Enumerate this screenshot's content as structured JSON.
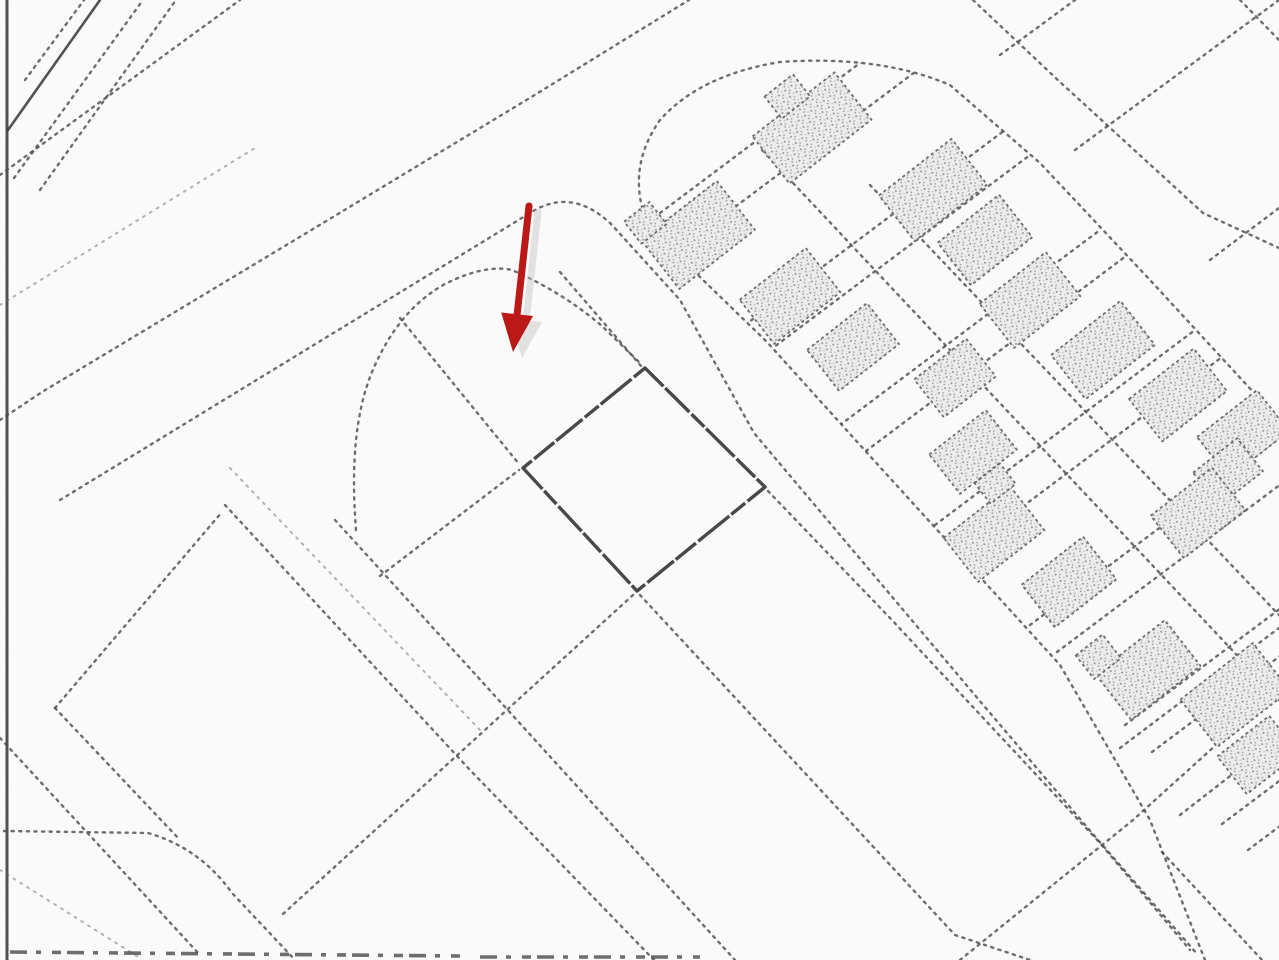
{
  "canvas": {
    "width": 1279,
    "height": 960
  },
  "colors": {
    "paper": "#ffffff",
    "ink": "#4e4e4e",
    "ink_dark": "#3a3a3a",
    "building_fill": "#ececec",
    "building_speckle": "#949494",
    "marker_red": "#bc1818",
    "marker_shadow": "#c4c4c4"
  },
  "marker": {
    "tail": [
      529,
      206
    ],
    "tip": [
      513,
      352
    ],
    "head_length": 38,
    "head_half_width": 16,
    "shaft_width": 7,
    "color": "#bc1818",
    "shadow_color": "#c4c4c4",
    "shadow_offset": [
      9,
      6
    ],
    "shadow_opacity": 0.45
  },
  "highlighted_parcel": {
    "points": "645,368 765,487 637,591 523,468"
  },
  "geometry": {
    "solid_lines": [
      {
        "d": "M7,0 L7,960",
        "w": 3
      },
      {
        "d": "M8,130 L100,0",
        "w": 2.6
      }
    ],
    "scan_marks": [
      {
        "d": "M10,952 L460,956"
      },
      {
        "d": "M480,957 L700,957"
      }
    ],
    "dotted": [
      {
        "d": "M25,80 L84,0"
      },
      {
        "d": "M14,178 L143,0"
      },
      {
        "d": "M40,190 L176,0"
      },
      {
        "d": "M0,175 L240,0"
      },
      {
        "d": "M0,305 L255,148",
        "c": "dot2"
      },
      {
        "d": "M0,420 L42,392 L333,217 L533,96 L689,0"
      },
      {
        "d": "M60,500 L530,213 Q572,186 612,225 L680,300 L754,433 L867,567 L979,700 L1092,833 L1198,955"
      },
      {
        "d": "M356,530 Q348,430 372,372 Q398,310 445,284 Q485,264 512,270 Q562,292 602,326 L641,364"
      },
      {
        "d": "M560,272 L641,366"
      },
      {
        "d": "M768,491 L890,618 L1000,736 L1100,843 L1190,950"
      },
      {
        "d": "M400,318 L519,464"
      },
      {
        "d": "M640,595 L955,935 L1030,960"
      },
      {
        "d": "M335,520 L735,960"
      },
      {
        "d": "M380,576 L519,470"
      },
      {
        "d": "M633,595 L283,914"
      },
      {
        "d": "M225,505 L470,770 L654,960"
      },
      {
        "d": "M230,468 L480,730",
        "c": "dot2"
      },
      {
        "d": "M55,708 L222,512"
      },
      {
        "d": "M55,708 L180,840"
      },
      {
        "d": "M0,738 L200,955"
      },
      {
        "d": "M4,831 L148,833 Q200,848 232,893 L295,960"
      },
      {
        "d": "M0,870 L140,958",
        "c": "dot2"
      },
      {
        "d": "M973,0 L1060,82 L1203,213 L1279,248"
      },
      {
        "d": "M1240,0 L1279,40"
      },
      {
        "d": "M1075,150 L1279,0"
      },
      {
        "d": "M1210,260 L1279,208"
      },
      {
        "d": "M1000,55 L1075,0"
      },
      {
        "d": "M960,960 L1133,820 L1279,688"
      },
      {
        "d": "M1162,852 L1262,960"
      },
      {
        "d": "M1120,748 L1279,628"
      },
      {
        "d": "M1180,815 L1279,738"
      }
    ],
    "band_outline": "M1205,960 L1150,820 L1060,665 L960,555 L860,445 L767,342 L703,280 L648,225 Q625,170 660,120 Q700,75 780,62 Q880,55 950,85 L1040,163 L1150,280 L1279,420",
    "band_clip": "M1205,960 L1150,820 L1060,665 L960,555 L860,445 L767,342 L703,280 L648,225 Q625,170 660,120 Q700,75 780,62 Q880,55 950,85 L1040,163 L1150,280 L1279,420 L1279,960 Z",
    "inner_lines": [
      {
        "d": "M762,150 L1279,700"
      },
      {
        "d": "M870,185 L1279,615"
      }
    ],
    "cross_streets": [
      {
        "d": "M648,222 L908,27"
      },
      {
        "d": "M675,252 L935,57"
      },
      {
        "d": "M745,325 L1005,130"
      },
      {
        "d": "M770,350 L1030,155"
      },
      {
        "d": "M840,425 L1100,230"
      },
      {
        "d": "M866,451 L1126,256"
      },
      {
        "d": "M935,525 L1195,330"
      },
      {
        "d": "M962,552 L1222,357"
      },
      {
        "d": "M1030,625 L1290,430"
      },
      {
        "d": "M1057,652 L1317,457"
      },
      {
        "d": "M1125,725 L1385,530"
      },
      {
        "d": "M1152,752 L1412,557"
      },
      {
        "d": "M1222,824 L1482,629"
      },
      {
        "d": "M1248,850 L1508,655"
      }
    ],
    "buildings": [
      {
        "cx": 812,
        "cy": 128,
        "w": 104,
        "h": 60,
        "rot": -38,
        "ext": [
          -18,
          -54,
          36,
          28
        ]
      },
      {
        "cx": 698,
        "cy": 235,
        "w": 96,
        "h": 62,
        "rot": -38,
        "ext": [
          -50,
          -56,
          32,
          28
        ]
      },
      {
        "cx": 790,
        "cy": 296,
        "w": 84,
        "h": 56,
        "rot": -38
      },
      {
        "cx": 853,
        "cy": 347,
        "w": 76,
        "h": 52,
        "rot": -38
      },
      {
        "cx": 933,
        "cy": 190,
        "w": 92,
        "h": 58,
        "rot": -38
      },
      {
        "cx": 985,
        "cy": 240,
        "w": 78,
        "h": 54,
        "rot": -38
      },
      {
        "cx": 1030,
        "cy": 300,
        "w": 84,
        "h": 56,
        "rot": -38
      },
      {
        "cx": 1103,
        "cy": 350,
        "w": 88,
        "h": 56,
        "rot": -38
      },
      {
        "cx": 1178,
        "cy": 395,
        "w": 82,
        "h": 54,
        "rot": -38
      },
      {
        "cx": 955,
        "cy": 378,
        "w": 66,
        "h": 48,
        "rot": -38
      },
      {
        "cx": 973,
        "cy": 452,
        "w": 72,
        "h": 50,
        "rot": -38
      },
      {
        "cx": 994,
        "cy": 534,
        "w": 84,
        "h": 56,
        "rot": -38,
        "ext": [
          16,
          -52,
          32,
          26
        ]
      },
      {
        "cx": 1069,
        "cy": 582,
        "w": 78,
        "h": 54,
        "rot": -38
      },
      {
        "cx": 1243,
        "cy": 434,
        "w": 76,
        "h": 52,
        "rot": -38
      },
      {
        "cx": 1228,
        "cy": 472,
        "w": 56,
        "h": 42,
        "rot": -38
      },
      {
        "cx": 1198,
        "cy": 513,
        "w": 78,
        "h": 54,
        "rot": -38
      },
      {
        "cx": 1148,
        "cy": 670,
        "w": 88,
        "h": 58,
        "rot": -38,
        "ext": [
          -48,
          -56,
          34,
          30
        ]
      },
      {
        "cx": 1235,
        "cy": 695,
        "w": 92,
        "h": 60,
        "rot": -38
      },
      {
        "cx": 1258,
        "cy": 755,
        "w": 66,
        "h": 48,
        "rot": -38
      }
    ]
  }
}
